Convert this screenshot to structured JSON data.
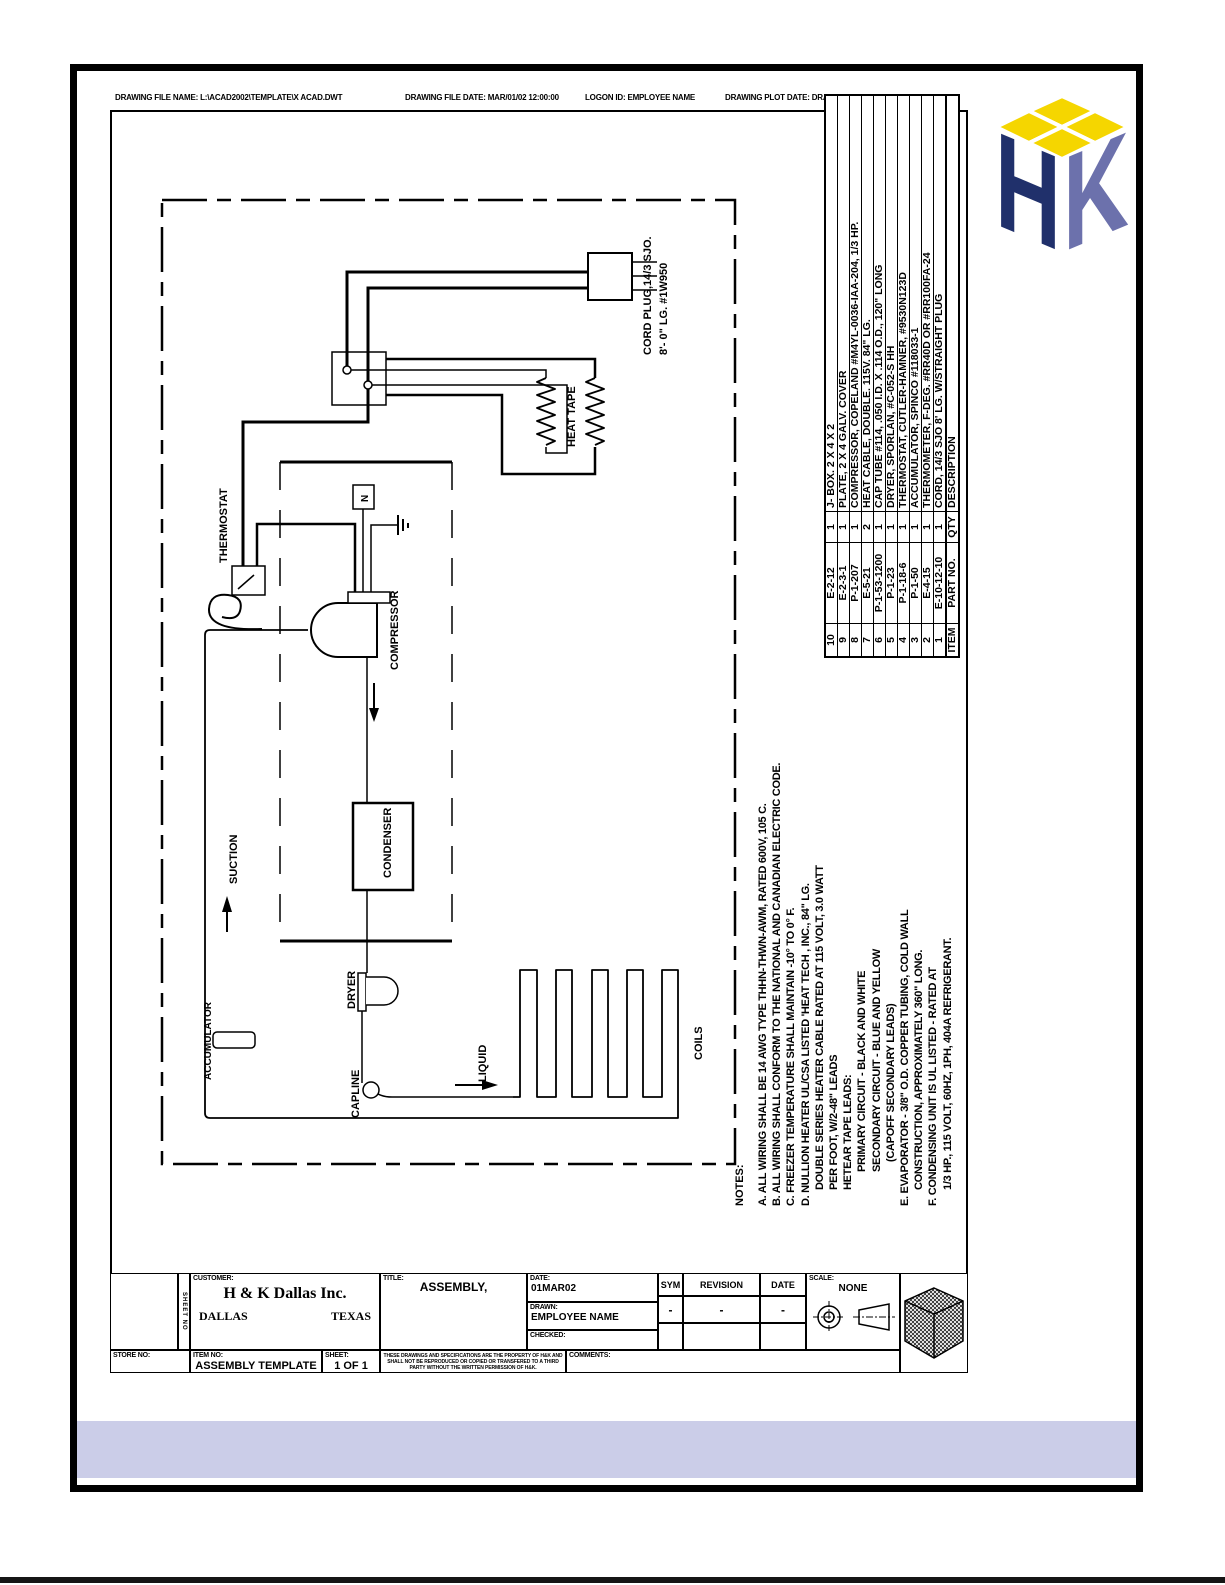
{
  "header": {
    "items": [
      "DRAWING FILE NAME:  L:\\ACAD2002\\TEMPLATE\\X ACAD.DWT",
      "DRAWING FILE DATE:  MAR/01/02   12:00:00",
      "LOGON ID: EMPLOYEE NAME",
      "DRAWING PLOT DATE:  DRAFT"
    ]
  },
  "logo": {
    "h": "H",
    "k": "K",
    "colors": {
      "h_face": "#20306B",
      "k_face": "#6C71AC",
      "top": "#F5D600"
    }
  },
  "parts_table": {
    "footer": [
      "ITEM",
      "PART NO.",
      "QTY",
      "DESCRIPTION"
    ],
    "rows": [
      [
        "10",
        "E-2-12",
        "1",
        "J- BOX. 2 X 4 X 2"
      ],
      [
        "9",
        "E-2-3-1",
        "1",
        "PLATE, 2 X 4 GALV. COVER"
      ],
      [
        "8",
        "P-1-207",
        "1",
        "COMPRESSOR, COPELAND #M4YL-0036-IAA-204, 1/3 HP."
      ],
      [
        "7",
        "E-5-21",
        "2",
        "HEAT CABLE, DOUBLE. 115V. 84\" LG."
      ],
      [
        "6",
        "P-1-53-1200",
        "1",
        "CAP TUBE #114, .050 I.D. X .114 O.D., 120\" LONG"
      ],
      [
        "5",
        "P-1-23",
        "1",
        "DRYER, SPORLAN, #C-052-S HH"
      ],
      [
        "4",
        "P-1-18-6",
        "1",
        "THERMOSTAT, CUTLER-HAMNER, #9530N123D"
      ],
      [
        "3",
        "P-1-50",
        "1",
        "ACCUMULATOR, SPINCO #118033-1"
      ],
      [
        "2",
        "E-4-15",
        "1",
        "THERMOMETER, F-DEG.  #RR40D OR #RR100FA-24"
      ],
      [
        "1",
        "E-10-12-10",
        "1",
        "CORD, 14/3 SJO  8' LG. W/STRAIGHT PLUG"
      ]
    ]
  },
  "notes": {
    "title": "NOTES:",
    "lines": [
      "A. ALL WIRING SHALL BE 14 AWG TYPE THHN-THWN-AWM, RATED 600V, 105 C.",
      "B. ALL WIRING SHALL CONFORM TO THE NATIONAL AND CANADIAN ELECTRIC CODE.",
      "C. FREEZER TEMPERATURE SHALL MAINTAIN -10° TO 0° F.",
      "D. NULLION HEATER UL/CSA LISTED 'HEAT TECH , INC., 84\" LG.",
      "DOUBLE SERIES HEATER CABLE RATED AT 115 VOLT, 3.0 WATT",
      "PER FOOT, W/2-48\" LEADS",
      "HETEAR TAPE LEADS:",
      "PRIMARY CIRCUIT - BLACK AND WHITE",
      "SECONDARY CIRCUIT - BLUE AND YELLOW",
      "(CAPOFF SECONDARY LEADS)",
      "E. EVAPORATOR - 3/8\" O.D. COPPER TUBING, COLD WALL",
      "CONSTRUCTION, APPROXIMATELY 360\" LONG.",
      "F. CONDENSING UNIT IS UL LISTED - RATED AT",
      "1/3 HP., 115 VOLT, 60HZ, 1PH, 404A REFRIGERANT."
    ]
  },
  "schematic": {
    "labels": {
      "thermostat": "THERMOSTAT",
      "compressor": "COMPRESSOR",
      "condenser": "CONDENSER",
      "dryer": "DRYER",
      "accumulator": "ACCUMULATOR",
      "capline": "CAPLINE",
      "coils": "COILS",
      "heat_tape": "HEAT TAPE",
      "suction": "SUCTION",
      "liquid": "LIQUID",
      "neutral": "N",
      "cord_plug_1": "CORD PLUG,14/3 SJO.",
      "cord_plug_2": "8'- 0\" LG. #1W950"
    }
  },
  "title_block": {
    "sheet_no_vertical": "SHEET NO",
    "customer_label": "CUSTOMER:",
    "customer_name": "H & K Dallas Inc.",
    "customer_city": "DALLAS",
    "customer_state": "TEXAS",
    "title_label": "TITLE:",
    "title_value": "ASSEMBLY,",
    "date_label": "DATE:",
    "date_value": "01MAR02",
    "drawn_label": "DRAWN:",
    "drawn_value": "EMPLOYEE NAME",
    "checked_label": "CHECKED:",
    "sym_label": "SYM",
    "revision_label": "REVISION",
    "rev_date_label": "DATE",
    "sym_dash": "-",
    "revision_dash": "-",
    "rev_date_dash": "-",
    "scale_label": "SCALE:",
    "scale_value": "NONE",
    "store_label": "STORE NO:",
    "item_label": "ITEM NO:",
    "item_value": "ASSEMBLY TEMPLATE B",
    "sheet_label": "SHEET:",
    "sheet_value": "1 OF 1",
    "disclaimer": "THESE DRAWINGS AND SPECIFICATIONS ARE THE PROPERTY OF H&K AND SHALL NOT BE REPRODUCED OR COPIED OR TRANSFERED TO A THIRD PARTY WITHOUT THE WRITTEN PERMISSION OF H&K.",
    "comments_label": "COMMENTS:"
  },
  "colors": {
    "band": "#CBCDE8"
  }
}
